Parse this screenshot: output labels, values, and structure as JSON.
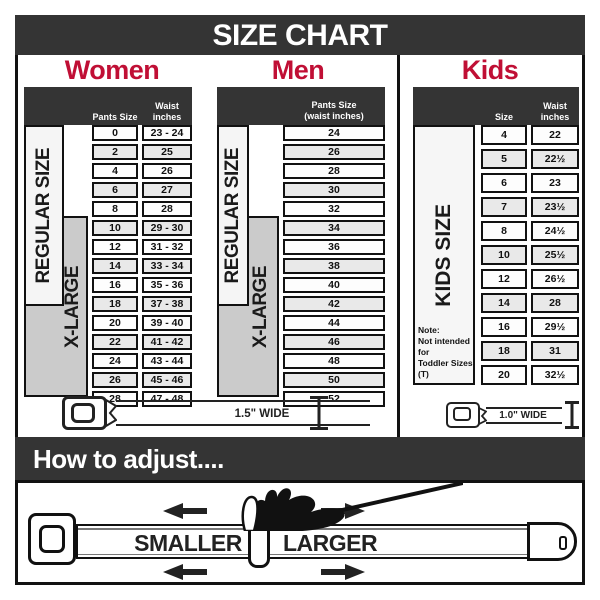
{
  "title": "SIZE CHART",
  "colors": {
    "dark": "#343434",
    "accent_red": "#c00f35",
    "row_alt_gray": "#e9e9e9",
    "xlarge_gray": "#cbcbcb"
  },
  "women": {
    "heading": "Women",
    "header": {
      "col1": "Pants Size",
      "col2": "Waist inches"
    },
    "regular_label": "REGULAR SIZE",
    "xlarge_label": "X-LARGE",
    "rows": [
      {
        "size": "0",
        "waist": "23 - 24"
      },
      {
        "size": "2",
        "waist": "25"
      },
      {
        "size": "4",
        "waist": "26"
      },
      {
        "size": "6",
        "waist": "27"
      },
      {
        "size": "8",
        "waist": "28"
      },
      {
        "size": "10",
        "waist": "29 - 30"
      },
      {
        "size": "12",
        "waist": "31 - 32"
      },
      {
        "size": "14",
        "waist": "33 - 34"
      },
      {
        "size": "16",
        "waist": "35 - 36"
      },
      {
        "size": "18",
        "waist": "37 - 38"
      },
      {
        "size": "20",
        "waist": "39 - 40"
      },
      {
        "size": "22",
        "waist": "41 - 42"
      },
      {
        "size": "24",
        "waist": "43 - 44"
      },
      {
        "size": "26",
        "waist": "45 - 46"
      },
      {
        "size": "28",
        "waist": "47 - 48"
      }
    ]
  },
  "men": {
    "heading": "Men",
    "header": {
      "line1": "Pants Size",
      "line2": "(waist inches)"
    },
    "regular_label": "REGULAR SIZE",
    "xlarge_label": "X-LARGE",
    "rows": [
      "24",
      "26",
      "28",
      "30",
      "32",
      "34",
      "36",
      "38",
      "40",
      "42",
      "44",
      "46",
      "48",
      "50",
      "52"
    ]
  },
  "kids": {
    "heading": "Kids",
    "header": {
      "col1": "Size",
      "col2": "Waist inches"
    },
    "label": "KIDS SIZE",
    "note": "Note:\nNot intended for\nToddler Sizes (T)",
    "rows": [
      {
        "size": "4",
        "waist": "22"
      },
      {
        "size": "5",
        "waist": "22½"
      },
      {
        "size": "6",
        "waist": "23"
      },
      {
        "size": "7",
        "waist": "23½"
      },
      {
        "size": "8",
        "waist": "24½"
      },
      {
        "size": "10",
        "waist": "25½"
      },
      {
        "size": "12",
        "waist": "26½"
      },
      {
        "size": "14",
        "waist": "28"
      },
      {
        "size": "16",
        "waist": "29½"
      },
      {
        "size": "18",
        "waist": "31"
      },
      {
        "size": "20",
        "waist": "32½"
      }
    ]
  },
  "belts": {
    "women_men_label": "1.5\" WIDE",
    "kids_label": "1.0\" WIDE"
  },
  "adjust": {
    "heading": "How to adjust....",
    "smaller": "SMALLER",
    "larger": "LARGER"
  }
}
